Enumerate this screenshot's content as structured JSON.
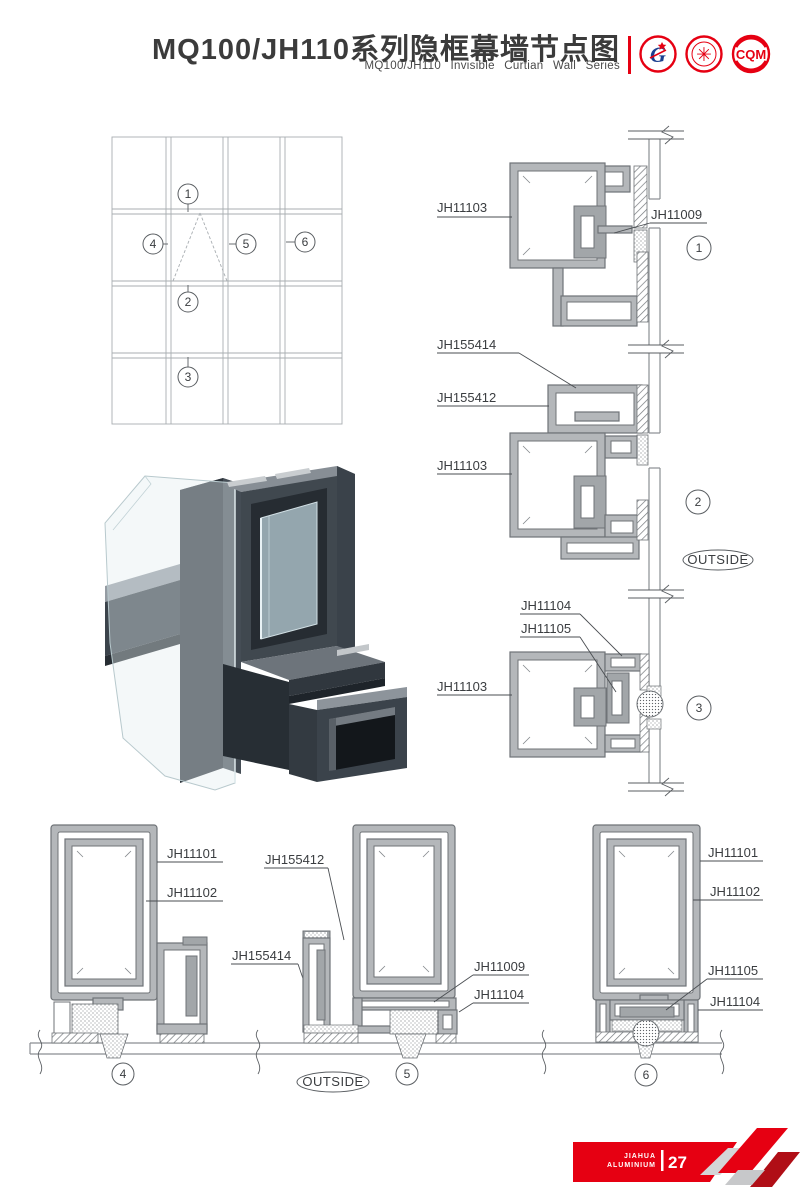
{
  "header": {
    "title": "MQ100/JH110系列隐框幕墙节点图",
    "subtitle": "MQ100/JH110 Invisible Curtian Wall Series",
    "logos": {
      "g_letter": "G",
      "cqm_text": "CQM",
      "seal_glyph": "✳"
    }
  },
  "colors": {
    "accent_red": "#e60012",
    "dark_red": "#b00e16",
    "profile_gray": "#b4b7ba",
    "line_gray": "#6f7377"
  },
  "elevation": {
    "callouts": [
      "1",
      "2",
      "3",
      "4",
      "5",
      "6"
    ]
  },
  "outside_label": "OUTSIDE",
  "details": {
    "d1": {
      "num": "1",
      "l1": "JH11103",
      "l2": "JH11009"
    },
    "d2": {
      "num": "2",
      "l1": "JH155414",
      "l2": "JH155412",
      "l3": "JH11103"
    },
    "d3": {
      "num": "3",
      "l1": "JH11104",
      "l2": "JH11105",
      "l3": "JH11103"
    },
    "d4": {
      "num": "4",
      "l1": "JH11101",
      "l2": "JH11102",
      "l3": "JH155414"
    },
    "d5": {
      "num": "5",
      "l1": "JH155412",
      "l2": "JH11009",
      "l3": "JH11104"
    },
    "d6": {
      "num": "6",
      "l1": "JH11101",
      "l2": "JH11102",
      "l3": "JH11105",
      "l4": "JH11104"
    }
  },
  "footer": {
    "brand_top": "JIAHUA",
    "brand_bottom": "ALUMINIUM",
    "page_number": "27"
  }
}
